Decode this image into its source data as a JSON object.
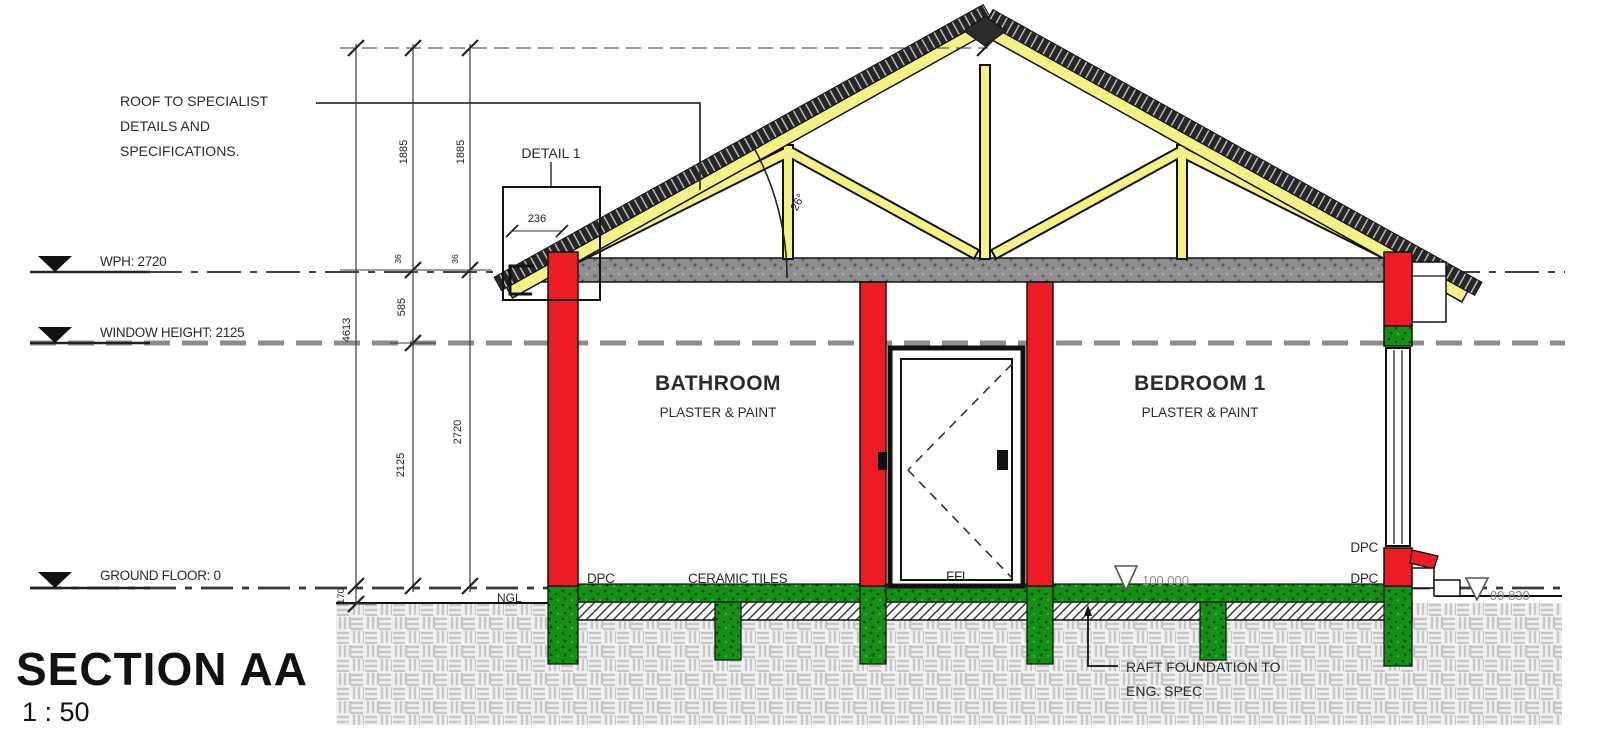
{
  "drawing": {
    "title": "SECTION AA",
    "scale": "1 : 50"
  },
  "levels": {
    "wph": "WPH: 2720",
    "window": "WINDOW HEIGHT: 2125",
    "ground": "GROUND FLOOR: 0"
  },
  "dims": {
    "roof_left": "1885",
    "roof_right": "1885",
    "total": "4613",
    "ceiling": "585",
    "wall": "2720",
    "window": "2125",
    "floor_drop": "170",
    "plate_b": "36",
    "plate_c": "36",
    "detail_width": "236",
    "roof_pitch": "26°"
  },
  "rooms": {
    "bathroom": {
      "name": "BATHROOM",
      "finish": "PLASTER & PAINT"
    },
    "bedroom": {
      "name": "BEDROOM 1",
      "finish": "PLASTER & PAINT"
    }
  },
  "notes": {
    "roof1": "ROOF TO SPECIALIST",
    "roof2": "DETAILS AND",
    "roof3": "SPECIFICATIONS.",
    "detail": "DETAIL 1",
    "raft1": "RAFT FOUNDATION TO",
    "raft2": "ENG. SPEC"
  },
  "floor": {
    "dpc_left": "DPC",
    "tiles": "CERAMIC TILES",
    "ngl": "NGL",
    "ffl": "FFL",
    "ffl_level": "100 000",
    "dpc_right_top": "DPC",
    "dpc_right_bottom": "DPC",
    "ngl_level": "99 830"
  },
  "colors": {
    "wall_red": "#ed1c24",
    "truss_yellow": "#f5f285",
    "foundation_green": "#149114",
    "slab_grey": "#8e8e8e",
    "roof_dark": "#262626"
  }
}
